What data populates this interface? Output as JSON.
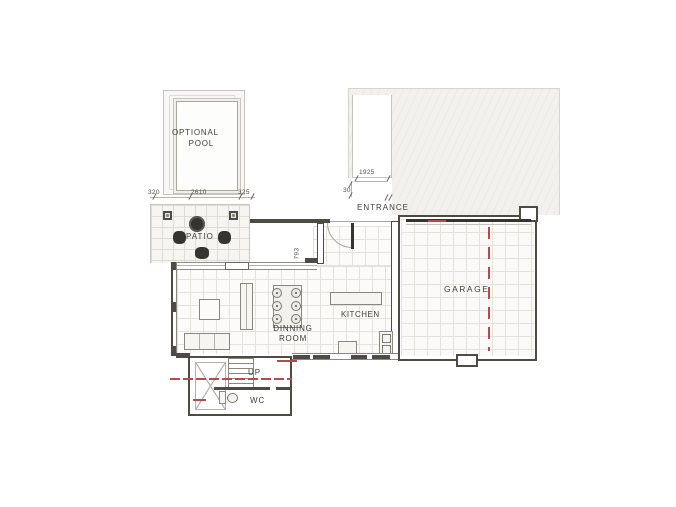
{
  "plan": {
    "labels": {
      "pool_line1": "OPTIONAL",
      "pool_line2": "POOL",
      "patio": "PATIO",
      "entrance": "ENTRANCE",
      "garage": "GARAGE",
      "kitchen": "KITCHEN",
      "dining_line1": "DINNING",
      "dining_line2": "ROOM",
      "stairs": "UP",
      "wc": "WC"
    },
    "dimensions": {
      "pool_left": "320",
      "pool_width": "2610",
      "pool_right": "325",
      "walkway_length": "1925",
      "entrance_setback": "30",
      "hall_depth": "793"
    },
    "colors": {
      "wall": "#4e4b45",
      "line_medium": "#8a877f",
      "grid_light": "#e4e2dd",
      "driveway_fill": "#f2f1ee",
      "furniture_dark": "#35342f",
      "centerline_red": "#b94a48",
      "text": "#3e3d39"
    }
  }
}
